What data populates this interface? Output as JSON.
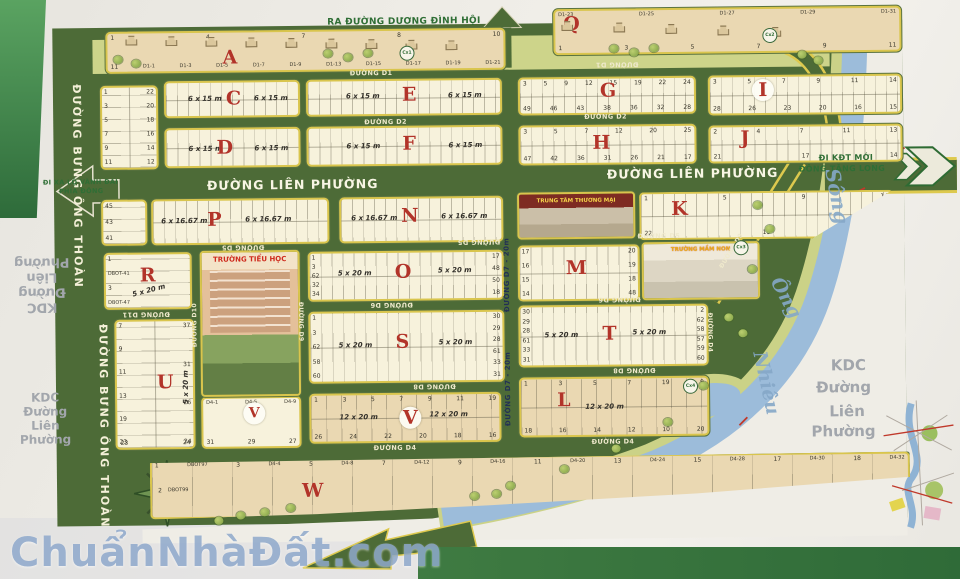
{
  "watermark": "ChuẩnNhàĐất.com",
  "map": {
    "directions": [
      {
        "t": "RA ĐƯỜNG DƯƠNG ĐÌNH HỘI",
        "x": 330,
        "y": 16,
        "c": "dir",
        "fs": 9
      },
      {
        "t": "ĐI XA LỘ VÀNH ĐAI",
        "x": 44,
        "y": 174,
        "c": "dir",
        "fs": 6.5
      },
      {
        "t": "PHÍA ĐÔNG",
        "x": 60,
        "y": 183,
        "c": "dir",
        "fs": 6.5
      },
      {
        "t": "ĐI KĐT MỚI",
        "x": 820,
        "y": 157,
        "c": "dir",
        "fs": 8
      },
      {
        "t": "ĐÔNG TĂNG LONG",
        "x": 800,
        "y": 168,
        "c": "dir",
        "fs": 8
      },
      {
        "t": "Sông",
        "x": 810,
        "y": 188,
        "c": "river",
        "fs": 20,
        "rot": 80
      },
      {
        "t": "Ông",
        "x": 764,
        "y": 290,
        "c": "river",
        "fs": 19,
        "rot": 62
      },
      {
        "t": "Nhiêu",
        "x": 733,
        "y": 375,
        "c": "river",
        "fs": 19,
        "rot": 78
      },
      {
        "t": "KDC",
        "x": 830,
        "y": 360,
        "c": "grey",
        "fs": 15
      },
      {
        "t": "Đường",
        "x": 815,
        "y": 382,
        "c": "grey",
        "fs": 15
      },
      {
        "t": "Liên",
        "x": 828,
        "y": 406,
        "c": "grey",
        "fs": 15
      },
      {
        "t": "Phường",
        "x": 810,
        "y": 426,
        "c": "grey",
        "fs": 15
      }
    ],
    "area_groups": [
      {
        "id": "kdc-left-rotated",
        "lines": [
          "KDC",
          "Đường",
          "Liên",
          "Phường"
        ],
        "x": 10,
        "y": 250,
        "w": 64,
        "fs": 13,
        "rot": 180
      },
      {
        "id": "kdc-left-bottom",
        "lines": [
          "KDC",
          "Đường",
          "Liên",
          "Phường"
        ],
        "x": 12,
        "y": 386,
        "w": 64,
        "fs": 12,
        "rot": 0
      }
    ],
    "street_labels": [
      {
        "t": "ĐƯỜNG D1",
        "x": 352,
        "y": 68,
        "c": "s"
      },
      {
        "t": "ĐƯỜNG D1",
        "x": 598,
        "y": 62,
        "c": "srev"
      },
      {
        "t": "ĐƯỜNG D2",
        "x": 366,
        "y": 117,
        "c": "s"
      },
      {
        "t": "ĐƯỜNG D2",
        "x": 586,
        "y": 114,
        "c": "s"
      },
      {
        "t": "ĐƯỜNG LIÊN PHƯỜNG",
        "x": 208,
        "y": 175,
        "c": "big"
      },
      {
        "t": "ĐƯỜNG LIÊN PHƯỜNG",
        "x": 608,
        "y": 168,
        "c": "big"
      },
      {
        "t": "ĐƯỜNG D5",
        "x": 222,
        "y": 241,
        "c": "srev"
      },
      {
        "t": "ĐƯỜNG D5",
        "x": 458,
        "y": 238,
        "c": "srev"
      },
      {
        "t": "ĐƯỜNG D5",
        "x": 638,
        "y": 234,
        "c": "s"
      },
      {
        "t": "ĐƯỜNG D6",
        "x": 370,
        "y": 300,
        "c": "srev"
      },
      {
        "t": "ĐƯỜNG D6",
        "x": 598,
        "y": 297,
        "c": "srev"
      },
      {
        "t": "ĐƯỜNG D8",
        "x": 412,
        "y": 382,
        "c": "srev"
      },
      {
        "t": "ĐƯỜNG D8",
        "x": 612,
        "y": 368,
        "c": "srev"
      },
      {
        "t": "ĐƯỜNG D4",
        "x": 372,
        "y": 443,
        "c": "s"
      },
      {
        "t": "ĐƯỜNG D4",
        "x": 590,
        "y": 439,
        "c": "s"
      },
      {
        "t": "ĐƯỜNG D11",
        "x": 122,
        "y": 307,
        "c": "srev"
      },
      {
        "t": "ĐƯỜNG D10",
        "x": 191,
        "y": 300,
        "c": "vup"
      },
      {
        "t": "ĐƯỜNG D9",
        "x": 297,
        "y": 300,
        "c": "vdown"
      },
      {
        "t": "ĐƯỜNG D4",
        "x": 706,
        "y": 315,
        "c": "vdown"
      },
      {
        "t": "ĐƯỜNG D7 - 20m",
        "x": 503,
        "y": 238,
        "c": "vupnavy"
      },
      {
        "t": "ĐƯỜNG D7 - 20m",
        "x": 503,
        "y": 352,
        "c": "vupnavy"
      },
      {
        "t": "ĐƯỜNG D9",
        "x": 712,
        "y": 250,
        "c": "diag"
      },
      {
        "t": "ĐƯỜNG BƯNG ÔNG THOÀN",
        "x": 72,
        "y": 80,
        "c": "bung"
      },
      {
        "t": "ĐƯỜNG BƯNG ÔNG THOÀN",
        "x": 96,
        "y": 320,
        "c": "bung"
      }
    ],
    "circles": [
      {
        "label": "Cx1",
        "x": 402,
        "y": 45
      },
      {
        "label": "Cx2",
        "x": 765,
        "y": 31
      },
      {
        "label": "Cx3",
        "x": 734,
        "y": 243
      },
      {
        "label": "Cx4",
        "x": 682,
        "y": 381
      }
    ],
    "landmarks": [
      {
        "id": "primary-school",
        "title": "TRƯỜNG TIỂU HỌC",
        "x": 200,
        "y": 248,
        "w": 100,
        "h": 146,
        "style": "school"
      },
      {
        "id": "trade-center",
        "title": "TRUNG TÂM THƯƠNG MẠI",
        "x": 518,
        "y": 193,
        "w": 118,
        "h": 47,
        "style": "mall"
      },
      {
        "id": "kindergarten",
        "title": "TRƯỜNG MẦM NON",
        "x": 642,
        "y": 244,
        "w": 118,
        "h": 58,
        "style": "kg"
      }
    ],
    "blocks": [
      {
        "id": "A",
        "tan": 1,
        "x": 108,
        "y": 28,
        "w": 400,
        "h": 42,
        "letter": "A",
        "lx": 115,
        "ly": 16,
        "nt": [
          "1",
          "4",
          "7",
          "8",
          "10"
        ],
        "nb": [
          "11",
          "D1-1",
          "D1-3",
          "D1-5",
          "D1-7",
          "D1-9",
          "D1-13",
          "D1-15",
          "D1-17",
          "D1-19",
          "D1-21"
        ]
      },
      {
        "id": "Q",
        "tan": 1,
        "x": 556,
        "y": 10,
        "w": 348,
        "h": 46,
        "letter": "Q",
        "lx": 8,
        "ly": 4,
        "nt": [
          "D1-23",
          "D1-25",
          "D1-27",
          "D1-29",
          "D1-31"
        ],
        "nb": [
          "1",
          "3",
          "5",
          "7",
          "9",
          "11"
        ]
      },
      {
        "id": "B",
        "x": 102,
        "y": 82,
        "w": 58,
        "h": 84,
        "hatch": "hh",
        "vm": 1,
        "nl": [
          "1",
          "3",
          "5",
          "7",
          "9",
          "11"
        ],
        "nr": [
          "22",
          "20",
          "18",
          "16",
          "14",
          "12"
        ]
      },
      {
        "id": "C",
        "x": 166,
        "y": 78,
        "w": 136,
        "h": 37,
        "hatch": "hv",
        "h2": 1,
        "letter": "C",
        "lx": 60,
        "ly": 7,
        "dims": [
          {
            "t": "6 x 15 m",
            "x": 22,
            "y": 12
          },
          {
            "t": "6 x 15 m",
            "x": 88,
            "y": 12
          }
        ]
      },
      {
        "id": "E",
        "x": 308,
        "y": 78,
        "w": 196,
        "h": 37,
        "hatch": "hv",
        "h2": 1,
        "letter": "E",
        "lx": 94,
        "ly": 5,
        "dims": [
          {
            "t": "6 x 15 m",
            "x": 38,
            "y": 11
          },
          {
            "t": "6 x 15 m",
            "x": 140,
            "y": 11
          }
        ]
      },
      {
        "id": "G",
        "x": 520,
        "y": 78,
        "w": 178,
        "h": 38,
        "hatch": "hv",
        "h2": 1,
        "letter": "G",
        "lx": 80,
        "ly": 3,
        "nt": [
          "3",
          "5",
          "9",
          "12",
          "15",
          "19",
          "22",
          "24"
        ],
        "nb": [
          "49",
          "46",
          "43",
          "38",
          "36",
          "32",
          "28"
        ]
      },
      {
        "id": "I",
        "x": 710,
        "y": 78,
        "w": 194,
        "h": 40,
        "hatch": "hv",
        "h2": 1,
        "letter": "I",
        "lx": 42,
        "ly": 2,
        "circ": 1,
        "nt": [
          "3",
          "5",
          "7",
          "9",
          "11",
          "14"
        ],
        "nb": [
          "28",
          "26",
          "23",
          "20",
          "16",
          "15"
        ]
      },
      {
        "id": "D",
        "x": 166,
        "y": 125,
        "w": 136,
        "h": 40,
        "hatch": "hv",
        "h2": 1,
        "letter": "D",
        "lx": 50,
        "ly": 9,
        "dims": [
          {
            "t": "6 x 15 m",
            "x": 22,
            "y": 15
          },
          {
            "t": "6 x 15 m",
            "x": 88,
            "y": 15
          }
        ]
      },
      {
        "id": "F",
        "x": 308,
        "y": 125,
        "w": 196,
        "h": 40,
        "hatch": "hv",
        "h2": 1,
        "letter": "F",
        "lx": 94,
        "ly": 7,
        "dims": [
          {
            "t": "6 x 15 m",
            "x": 38,
            "y": 14
          },
          {
            "t": "6 x 15 m",
            "x": 140,
            "y": 14
          }
        ]
      },
      {
        "id": "H",
        "x": 520,
        "y": 126,
        "w": 178,
        "h": 40,
        "hatch": "hv",
        "h2": 1,
        "letter": "H",
        "lx": 72,
        "ly": 7,
        "nt": [
          "3",
          "5",
          "7",
          "12",
          "20",
          "25"
        ],
        "nb": [
          "47",
          "42",
          "36",
          "31",
          "26",
          "21",
          "17"
        ]
      },
      {
        "id": "J",
        "x": 710,
        "y": 128,
        "w": 194,
        "h": 38,
        "hatch": "hv",
        "h2": 1,
        "letter": "J",
        "lx": 30,
        "ly": 2,
        "nt": [
          "2",
          "4",
          "7",
          "11",
          "13"
        ],
        "nb": [
          "21",
          "17",
          "14"
        ]
      },
      {
        "id": "P-west",
        "x": 102,
        "y": 196,
        "w": 46,
        "h": 46,
        "hatch": "hh",
        "nl": [
          "45",
          "43",
          "41"
        ]
      },
      {
        "id": "P",
        "x": 152,
        "y": 196,
        "w": 178,
        "h": 46,
        "hatch": "hv",
        "h2": 1,
        "letter": "P",
        "lx": 54,
        "ly": 10,
        "dims": [
          {
            "t": "6 x 16.67 m",
            "x": 8,
            "y": 16
          },
          {
            "t": "6 x 16.67 m",
            "x": 92,
            "y": 15
          }
        ]
      },
      {
        "id": "N",
        "x": 340,
        "y": 196,
        "w": 164,
        "h": 46,
        "hatch": "hv",
        "h2": 1,
        "letter": "N",
        "lx": 60,
        "ly": 8,
        "dims": [
          {
            "t": "6 x 16.67 m",
            "x": 10,
            "y": 15
          },
          {
            "t": "6 x 16.67 m",
            "x": 100,
            "y": 14
          }
        ]
      },
      {
        "id": "K",
        "x": 640,
        "y": 194,
        "w": 254,
        "h": 48,
        "hatch": "hv",
        "h2": 1,
        "letter": "K",
        "lx": 30,
        "ly": 6,
        "clip": "polygon(0 0,100% 0,68% 100%,0 100%)",
        "nt": [
          "1",
          "5",
          "9",
          "14"
        ],
        "nb": [
          "22",
          "19",
          "15"
        ]
      },
      {
        "id": "R",
        "x": 104,
        "y": 249,
        "w": 88,
        "h": 57,
        "hatch": "hh",
        "letter": "R",
        "lx": 34,
        "ly": 12,
        "dims": [
          {
            "t": "5 x 20 m",
            "x": 26,
            "y": 32,
            "r": -14
          }
        ],
        "nl": [
          "1",
          "DBOT-41",
          "3",
          "DBOT-47"
        ]
      },
      {
        "id": "O",
        "x": 308,
        "y": 250,
        "w": 196,
        "h": 50,
        "hatch": "hv",
        "h2": 1,
        "letter": "O",
        "lx": 85,
        "ly": 10,
        "dims": [
          {
            "t": "5 x 20 m",
            "x": 28,
            "y": 16
          },
          {
            "t": "5 x 20 m",
            "x": 128,
            "y": 14
          }
        ],
        "nl": [
          "1",
          "3",
          "62",
          "32",
          "34"
        ],
        "nr": [
          "17",
          "48",
          "50",
          "18"
        ]
      },
      {
        "id": "M",
        "x": 518,
        "y": 246,
        "w": 122,
        "h": 56,
        "hatch": "hv",
        "h2": 1,
        "letter": "M",
        "lx": 46,
        "ly": 12,
        "nl": [
          "17",
          "16",
          "15",
          "14"
        ],
        "nr": [
          "20",
          "19",
          "18",
          "48"
        ]
      },
      {
        "id": "U",
        "x": 114,
        "y": 316,
        "w": 80,
        "h": 130,
        "hatch": "hh",
        "vm": 1,
        "letter": "U",
        "lx": 40,
        "ly": 52,
        "dims": [
          {
            "t": "5 x 20 m",
            "x": 52,
            "y": 62,
            "r": -90
          }
        ],
        "nl": [
          "7",
          "9",
          "11",
          "13",
          "19",
          "23"
        ],
        "nr": [
          "37",
          "31",
          "26",
          "24"
        ],
        "nb": [
          "23",
          "24"
        ]
      },
      {
        "id": "S",
        "x": 308,
        "y": 310,
        "w": 196,
        "h": 72,
        "hatch": "hv",
        "h2": 1,
        "letter": "S",
        "lx": 85,
        "ly": 20,
        "dims": [
          {
            "t": "5 x 20 m",
            "x": 28,
            "y": 28
          },
          {
            "t": "5 x 20 m",
            "x": 128,
            "y": 26
          }
        ],
        "nl": [
          "1",
          "3",
          "62",
          "58",
          "60"
        ],
        "nr": [
          "30",
          "29",
          "28",
          "61",
          "33",
          "31"
        ]
      },
      {
        "id": "T",
        "x": 518,
        "y": 306,
        "w": 190,
        "h": 62,
        "hatch": "hv",
        "h2": 1,
        "letter": "T",
        "lx": 82,
        "ly": 18,
        "dims": [
          {
            "t": "5 x 20 m",
            "x": 24,
            "y": 24
          },
          {
            "t": "5 x 20 m",
            "x": 112,
            "y": 22
          }
        ],
        "nl": [
          "30",
          "29",
          "28",
          "61",
          "33",
          "31"
        ],
        "nr": [
          "2",
          "62",
          "58",
          "57",
          "59",
          "60"
        ]
      },
      {
        "id": "V",
        "tan": 1,
        "x": 308,
        "y": 392,
        "w": 192,
        "h": 50,
        "hatch": "hv16",
        "h2": 1,
        "letter": "V",
        "lx": 88,
        "ly": 12,
        "circ": 1,
        "dims": [
          {
            "t": "12 x 20 m",
            "x": 28,
            "y": 18
          },
          {
            "t": "12 x 20 m",
            "x": 118,
            "y": 16
          }
        ],
        "nt": [
          "1",
          "3",
          "5",
          "7",
          "9",
          "11",
          "19"
        ],
        "nb": [
          "26",
          "24",
          "22",
          "20",
          "18",
          "16"
        ]
      },
      {
        "id": "L",
        "tan": 1,
        "x": 518,
        "y": 378,
        "w": 190,
        "h": 60,
        "hatch": "hv16",
        "h2": 1,
        "letter": "L",
        "lx": 36,
        "ly": 12,
        "dims": [
          {
            "t": "12 x 20 m",
            "x": 64,
            "y": 24
          }
        ],
        "nt": [
          "1",
          "3",
          "5",
          "7",
          "19",
          "9"
        ],
        "nb": [
          "18",
          "16",
          "14",
          "12",
          "10",
          "20"
        ]
      },
      {
        "id": "V-school",
        "x": 200,
        "y": 394,
        "w": 100,
        "h": 52,
        "letter": "V",
        "lx": 40,
        "ly": 4,
        "ls": 14,
        "circ": 1,
        "nt": [
          "D4-1",
          "D4-5",
          "D4-9"
        ],
        "nb": [
          "31",
          "29",
          "27"
        ]
      },
      {
        "id": "W",
        "tan": 1,
        "x": 148,
        "y": 456,
        "w": 760,
        "h": 60,
        "hatch": "hv40",
        "letter": "W",
        "lx": 150,
        "ly": 22,
        "clip": "polygon(0 6%,100% 0,100% 42%,72% 66%,45% 82%,22% 94%,0 100%)",
        "nt": [
          "1",
          "DBOT97",
          "3",
          "D4-4",
          "5",
          "D4-8",
          "7",
          "D4-12",
          "9",
          "D4-16",
          "11",
          "D4-20",
          "13",
          "D4-24",
          "15",
          "D4-28",
          "17",
          "D4-30",
          "18",
          "D4-32"
        ],
        "n2": [
          "2",
          "DBOT99"
        ]
      }
    ],
    "trees": [
      [
        116,
        52
      ],
      [
        134,
        56
      ],
      [
        326,
        48
      ],
      [
        346,
        52
      ],
      [
        366,
        48
      ],
      [
        612,
        46
      ],
      [
        632,
        50
      ],
      [
        652,
        46
      ],
      [
        800,
        54
      ],
      [
        816,
        60
      ],
      [
        754,
        204
      ],
      [
        766,
        228
      ],
      [
        748,
        268
      ],
      [
        724,
        316
      ],
      [
        738,
        332
      ],
      [
        698,
        384
      ],
      [
        662,
        420
      ],
      [
        610,
        446
      ],
      [
        558,
        466
      ],
      [
        504,
        482
      ],
      [
        468,
        492
      ],
      [
        212,
        514
      ],
      [
        234,
        509
      ],
      [
        258,
        506
      ],
      [
        284,
        502
      ],
      [
        490,
        490
      ]
    ],
    "houses": {
      "A": [
        [
          128,
          32
        ],
        [
          168,
          33
        ],
        [
          208,
          34
        ],
        [
          248,
          35
        ],
        [
          288,
          36
        ],
        [
          328,
          37
        ],
        [
          368,
          38
        ],
        [
          408,
          39
        ],
        [
          448,
          40
        ]
      ],
      "Q": [
        [
          564,
          22
        ],
        [
          616,
          24
        ],
        [
          668,
          26
        ],
        [
          720,
          28
        ],
        [
          772,
          30
        ]
      ]
    },
    "river_name": "Sông Ông Nhiêu"
  }
}
